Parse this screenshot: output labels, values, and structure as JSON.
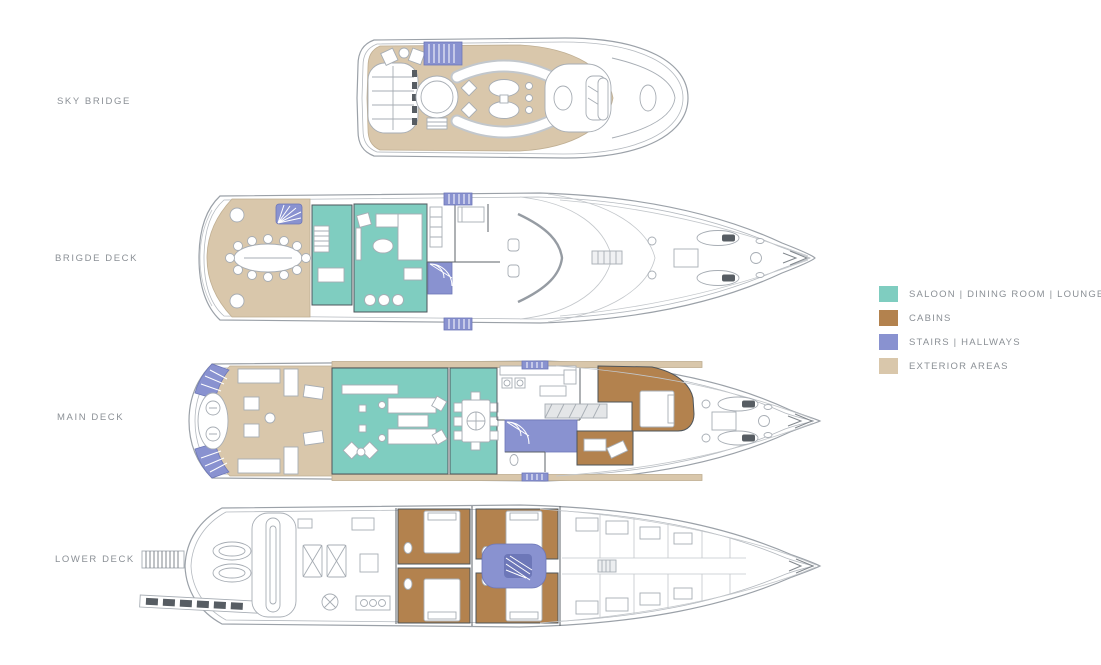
{
  "page": {
    "background": "#ffffff"
  },
  "deck_labels": [
    {
      "id": "sky-bridge",
      "label": "SKY BRIDGE"
    },
    {
      "id": "brigde-deck",
      "label": "BRIGDE DECK"
    },
    {
      "id": "main-deck",
      "label": "MAIN DECK"
    },
    {
      "id": "lower-deck",
      "label": "LOWER DECK"
    }
  ],
  "legend": {
    "items": [
      {
        "key": "saloon",
        "label": "SALOON | DINING ROOM | LOUNGE",
        "color": "#7fcdc0"
      },
      {
        "key": "cabins",
        "label": "CABINS",
        "color": "#b3824e"
      },
      {
        "key": "stairs",
        "label": "STAIRS | HALLWAYS",
        "color": "#8992d0"
      },
      {
        "key": "exterior",
        "label": "EXTERIOR AREAS",
        "color": "#d9c7ab"
      }
    ]
  },
  "colors": {
    "label_text": "#8b9096",
    "hull_line": "#9ba1a8"
  }
}
